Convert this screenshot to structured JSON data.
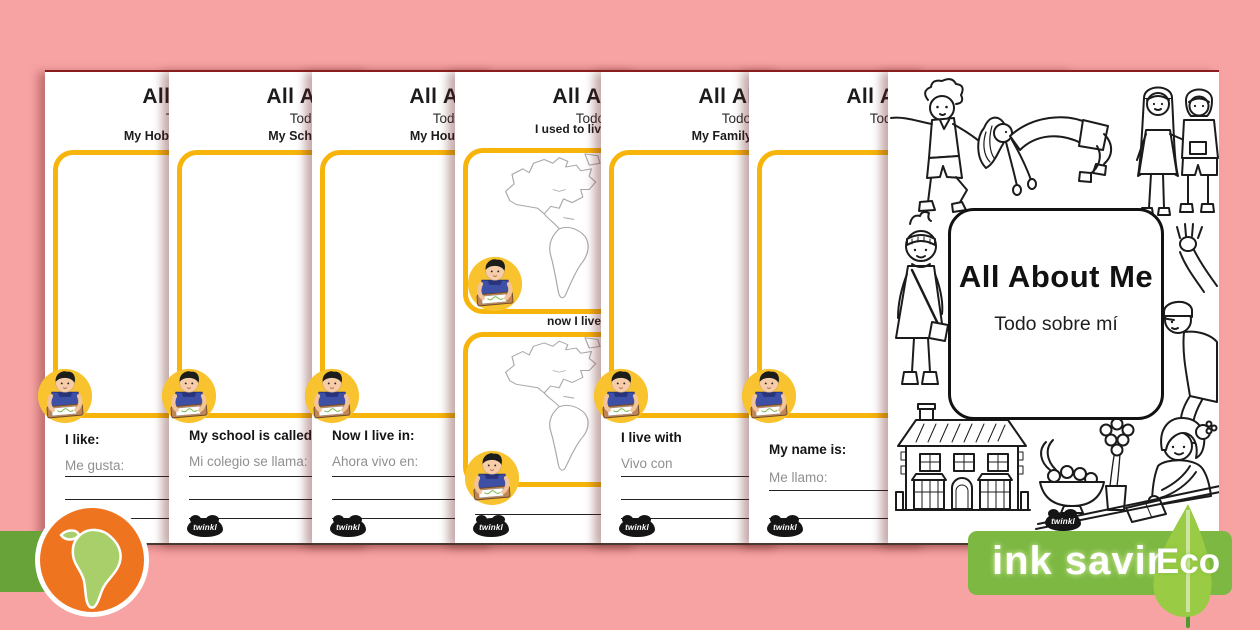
{
  "colors": {
    "background_pink": "#F8A3A3",
    "frame_yellow": "#F7B50C",
    "circle_yellow": "#F9C32F",
    "banner_green": "#7DB843",
    "leaf_green": "#9ACB44",
    "tab_green": "#67A339",
    "globe_orange": "#EE7420",
    "continent_green": "#A9CF6B",
    "sheet_edge_red": "#8A1E1E"
  },
  "brand": {
    "logo_text": "twinkl"
  },
  "sheet_common": {
    "header": "All About Me",
    "subtitle": "Todo sobre mí"
  },
  "sheets": [
    {
      "section": "My Hob",
      "prompt_en": "I like:",
      "prompt_es": "Me gusta:"
    },
    {
      "section": "My Sch",
      "prompt_en": "My school is called:",
      "prompt_es": "Mi colegio se llama:"
    },
    {
      "section": "My Hou",
      "prompt_en": "Now I live in:",
      "prompt_es": "Ahora vivo en:"
    },
    {
      "label_top": "I used to liv",
      "label_bottom": "now I live"
    },
    {
      "section": "My Family",
      "prompt_en": "I live with",
      "prompt_es": "Vivo con"
    },
    {
      "prompt_en": "My name is:",
      "prompt_es": "Me llamo:"
    }
  ],
  "cover": {
    "title": "All About Me",
    "subtitle": "Todo sobre mí"
  },
  "eco_badge": {
    "label": "ink saving",
    "eco_label": "Eco"
  }
}
